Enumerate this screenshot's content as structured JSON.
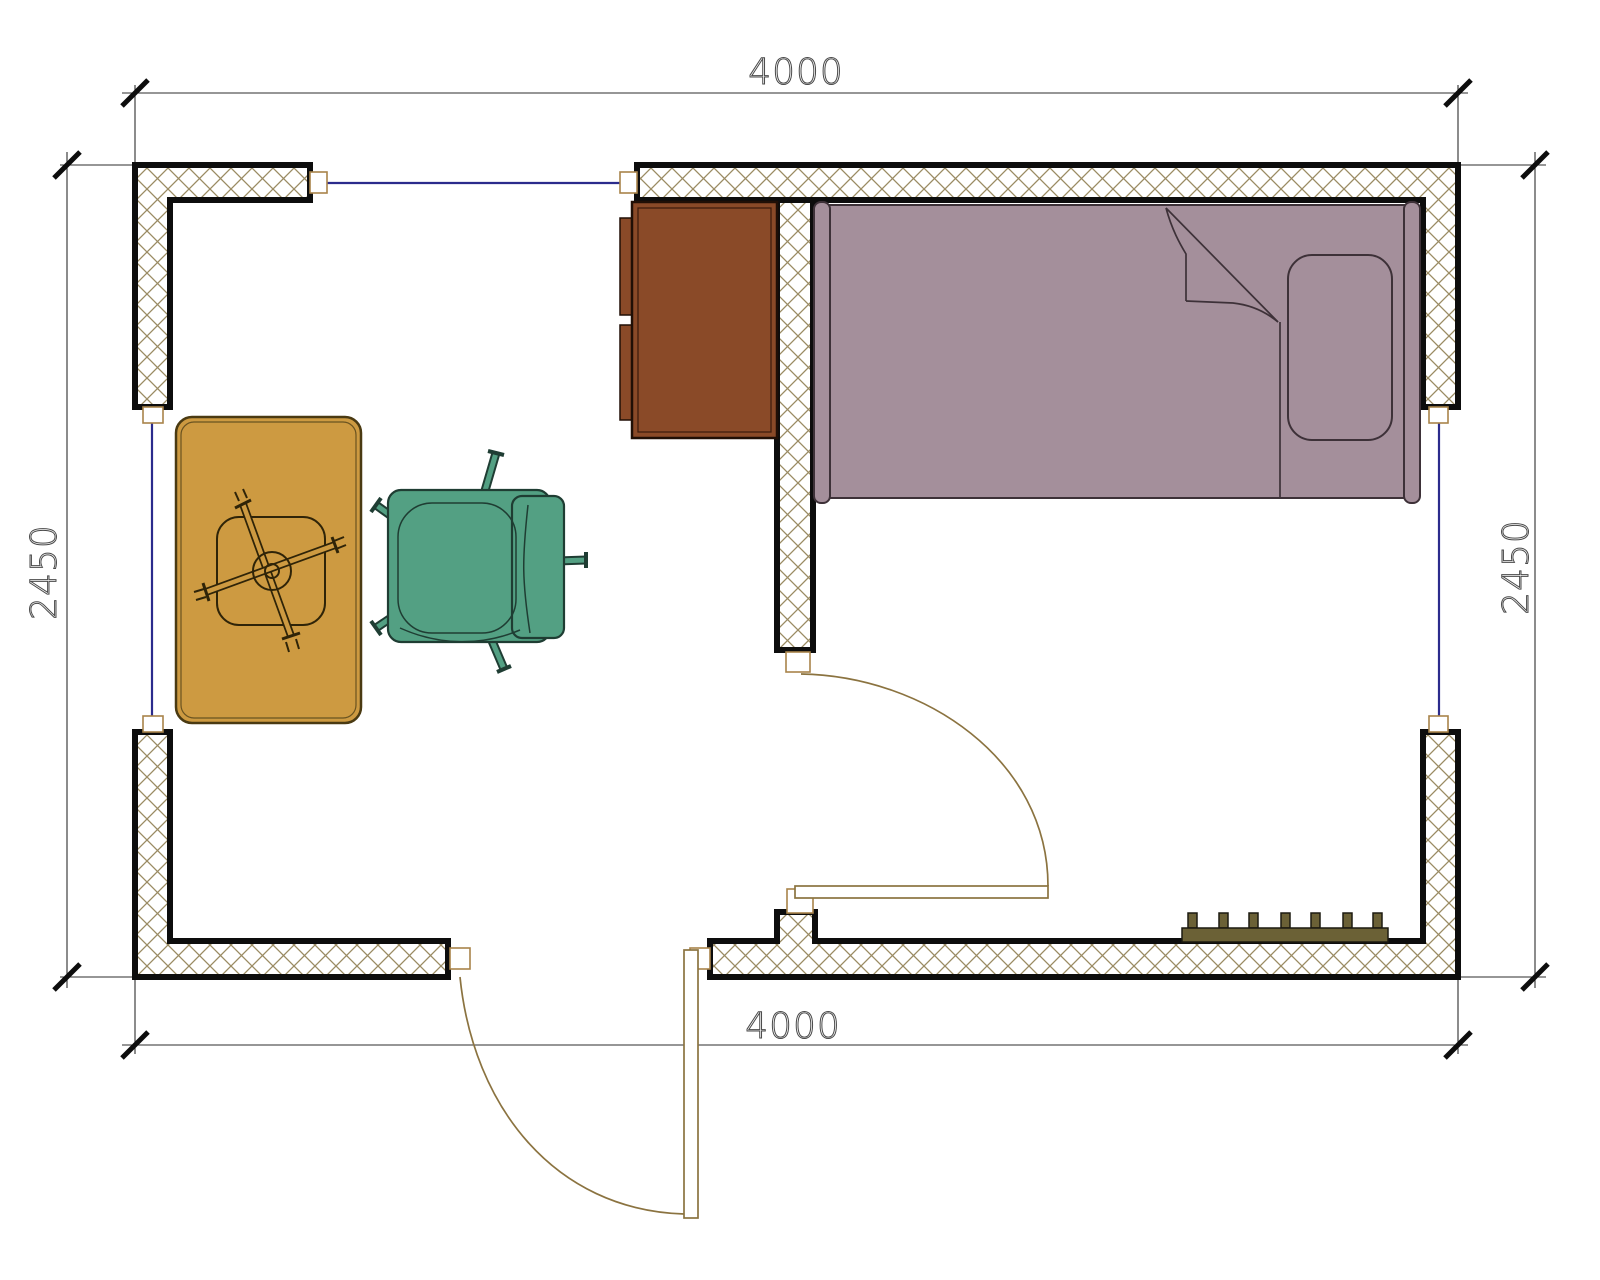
{
  "drawing": {
    "type": "architectural floor plan, top view, single room"
  },
  "dimensions": {
    "top": "4000",
    "bottom": "4000",
    "left": "2450",
    "right": "2450"
  },
  "objects": [
    {
      "name": "bed",
      "color_key": "bed"
    },
    {
      "name": "pillow",
      "color_key": "bed"
    },
    {
      "name": "wardrobe-cabinet",
      "color_key": "cabinet"
    },
    {
      "name": "pedestal-table",
      "color_key": "table"
    },
    {
      "name": "office-chair",
      "color_key": "chair"
    },
    {
      "name": "radiator",
      "color_key": "radiator"
    },
    {
      "name": "entry-door",
      "color_key": "door"
    },
    {
      "name": "interior-door",
      "color_key": "door"
    },
    {
      "name": "window-top",
      "color_key": "window_glass"
    },
    {
      "name": "window-left",
      "color_key": "window_glass"
    },
    {
      "name": "window-right",
      "color_key": "window_glass"
    }
  ],
  "colors": {
    "background": "#ffffff",
    "wall_border": "#0d0d0d",
    "wall_hatch": "#9a8a62",
    "frame": "#a8834a",
    "window_glass": "#2b2b8c",
    "door": "#8b7340",
    "dim_line": "#2e2e2e",
    "dim_text": "#4a4a4a",
    "bed": "#a48f9b",
    "bed_line": "#3d3138",
    "cabinet": "#8a4a28",
    "table": "#cd9a41",
    "chair": "#53a083",
    "chair_line": "#1f3d33",
    "radiator": "#6b6136"
  }
}
